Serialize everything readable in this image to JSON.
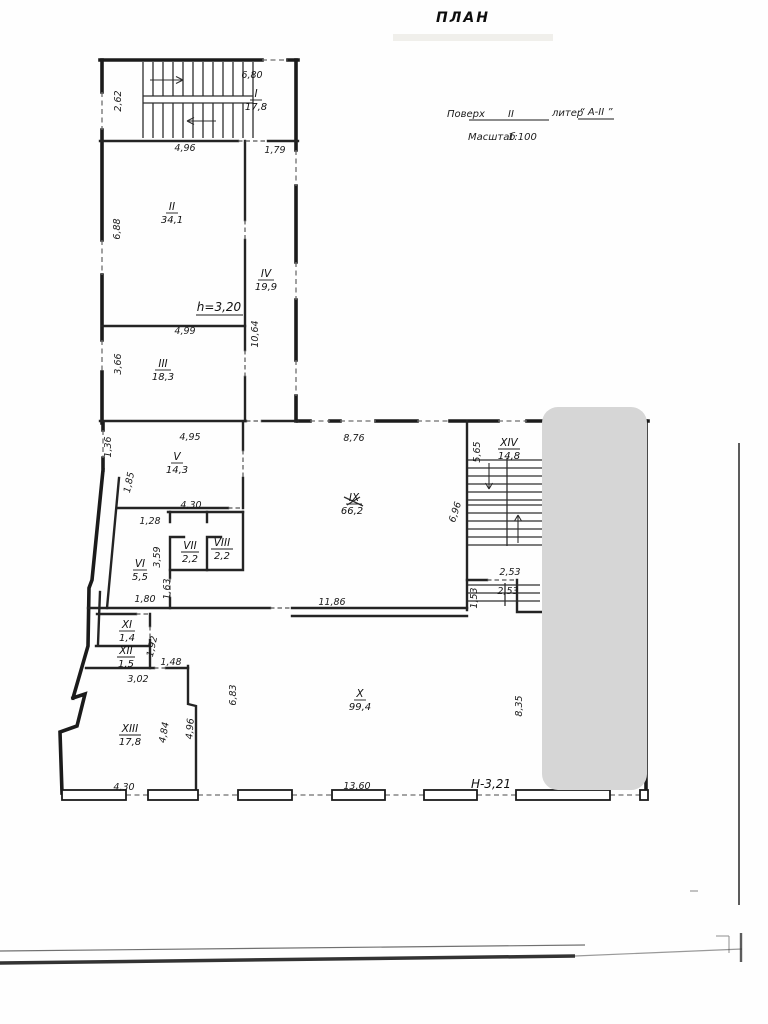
{
  "title": "ПЛАН",
  "header": {
    "floor_label": "Поверх",
    "floor_value": "II",
    "liter_label": "литер",
    "liter_value": "“ А-II ”",
    "scale_label": "Масштаб",
    "scale_value": "1:100"
  },
  "notes": {
    "ceiling_height": "h=3,20",
    "height_mark": "Н-3,21"
  },
  "rooms": [
    {
      "numeral": "I",
      "area": "17,8"
    },
    {
      "numeral": "II",
      "area": "34,1"
    },
    {
      "numeral": "III",
      "area": "18,3"
    },
    {
      "numeral": "IV",
      "area": "19,9"
    },
    {
      "numeral": "V",
      "area": "14,3"
    },
    {
      "numeral": "VI",
      "area": "5,5"
    },
    {
      "numeral": "VII",
      "area": "2,2"
    },
    {
      "numeral": "VIII",
      "area": "2,2"
    },
    {
      "numeral": "IX",
      "area": "66,2"
    },
    {
      "numeral": "X",
      "area": "99,4"
    },
    {
      "numeral": "XI",
      "area": "1,4"
    },
    {
      "numeral": "XII",
      "area": "1,5"
    },
    {
      "numeral": "XIII",
      "area": "17,8"
    },
    {
      "numeral": "XIV",
      "area": "14,8"
    }
  ],
  "dims": [
    "6,80",
    "2,62",
    "4,96",
    "1,79",
    "6,88",
    "4,99",
    "10,64",
    "3,66",
    "1,36",
    "4,95",
    "1,85",
    "4,30",
    "1,28",
    "3,59",
    "1,63",
    "1,80",
    "8,76",
    "5,65",
    "6,96",
    "11,86",
    "1,53",
    "2,53",
    "2,53",
    "1,92",
    "1,48",
    "3,02",
    "6,83",
    "4,84",
    "4,96",
    "4,30",
    "13,60",
    "8,35"
  ]
}
